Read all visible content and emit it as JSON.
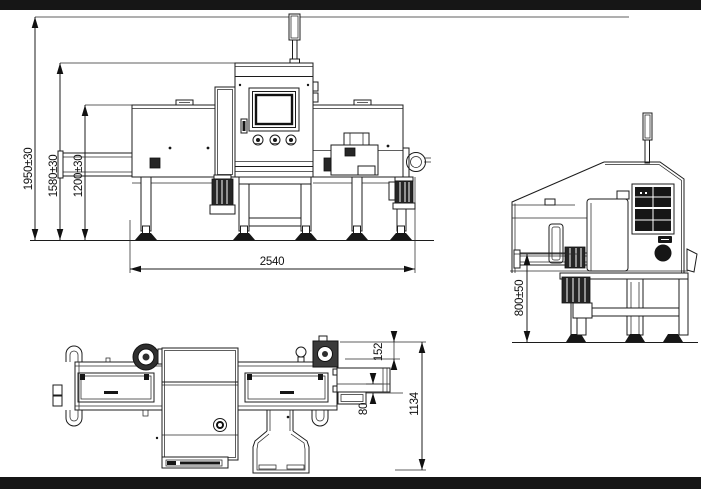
{
  "drawing": {
    "dimensions": {
      "front": {
        "overall_height": "1950±30",
        "cabinet_height": "1580±30",
        "infeed_height": "1200±30",
        "overall_length": "2540"
      },
      "side": {
        "belt_height": "800±50"
      },
      "top": {
        "outfeed_offset": "152",
        "belt_edge": "80",
        "overall_width": "1134"
      }
    },
    "colors": {
      "line": "#1c1c1c",
      "background": "#ffffff",
      "letterbox_bar": "#000000"
    }
  }
}
